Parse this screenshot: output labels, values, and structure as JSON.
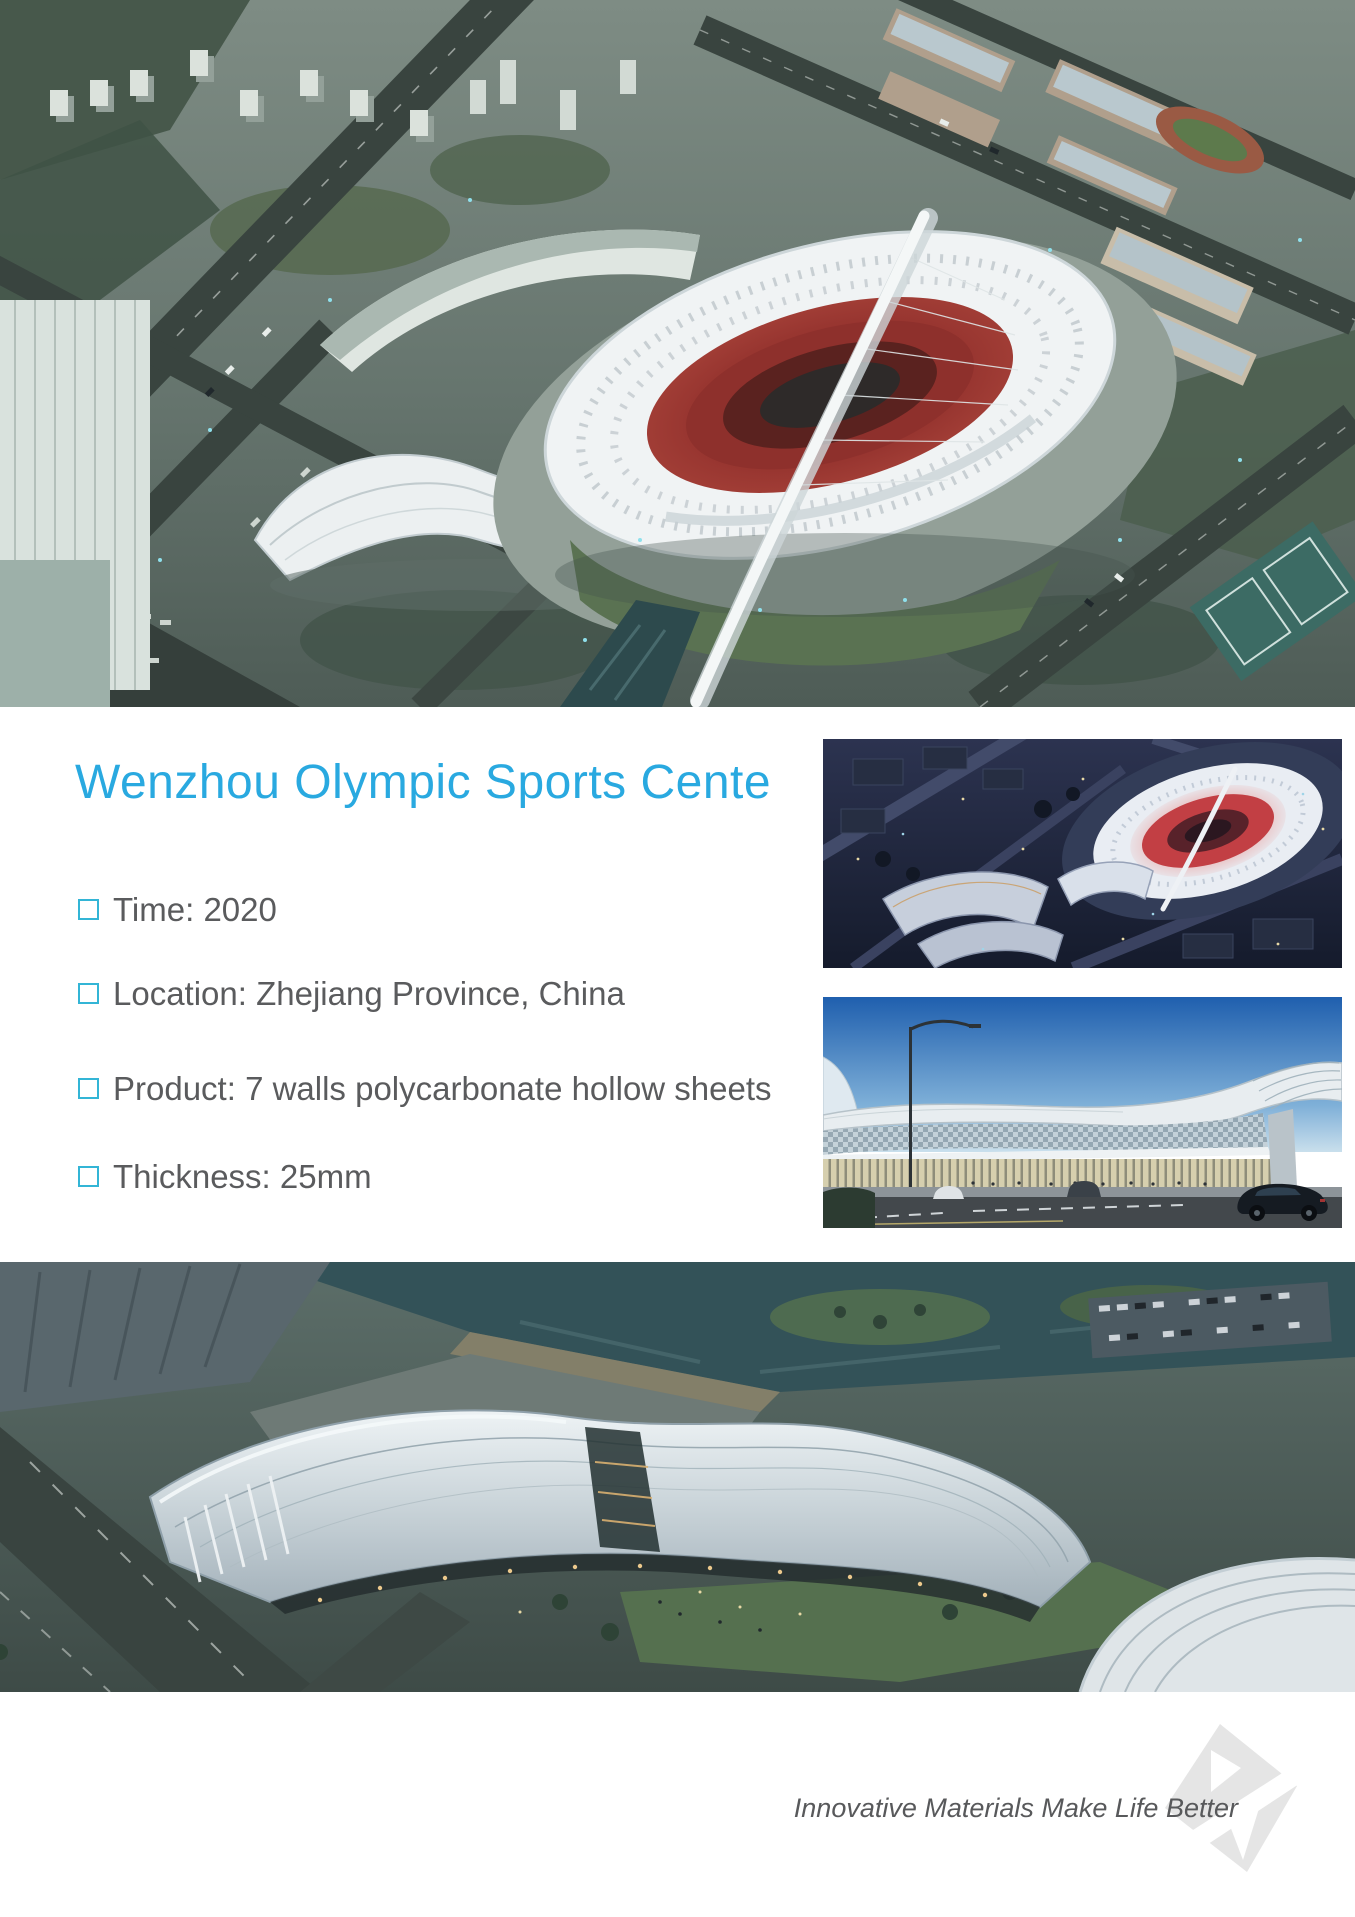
{
  "doc": {
    "title": "Wenzhou Olympic Sports Cente",
    "specs": [
      "Time: 2020",
      "Location: Zhejiang Province, China",
      "Product: 7 walls polycarbonate hollow sheets",
      "Thickness: 25mm"
    ],
    "footer_slogan": "Innovative Materials Make Life Better"
  },
  "icons": {
    "bullet": "square-outline-icon",
    "logo": "brand-diamond-mark"
  },
  "colors": {
    "accent": "#29A9E0",
    "bullet": "#33B5D6",
    "text": "#5A5B5D",
    "slogan": "#58595B"
  }
}
